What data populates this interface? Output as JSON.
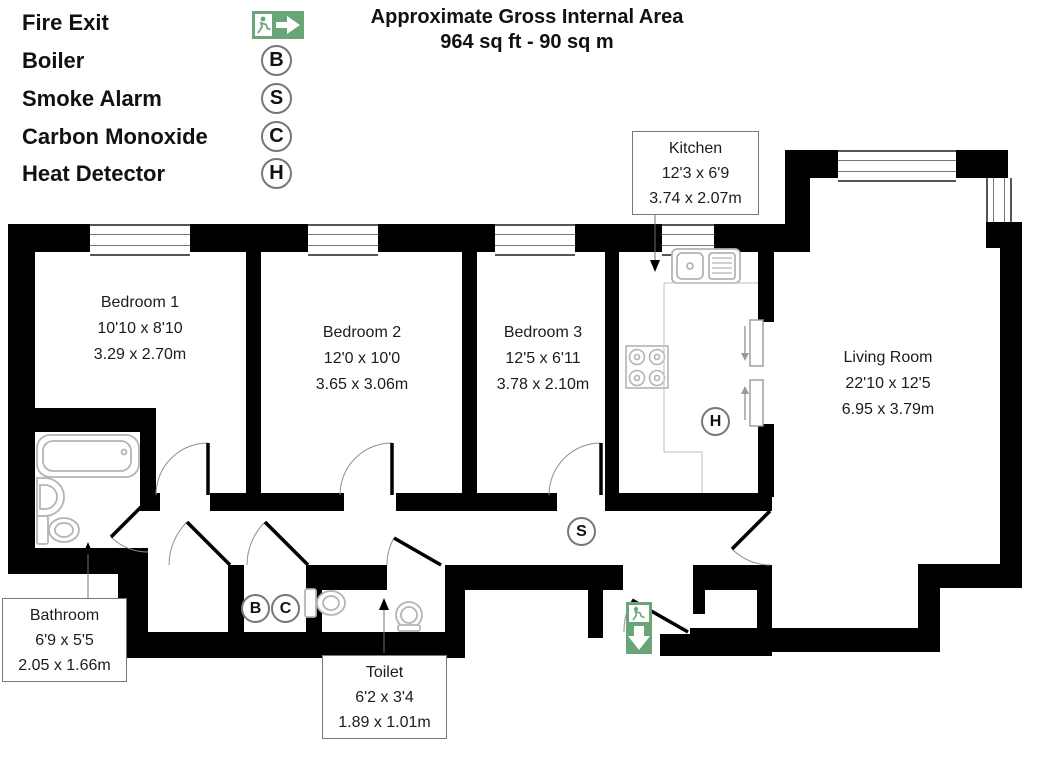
{
  "legend": {
    "items": [
      {
        "label": "Fire Exit",
        "type": "icon",
        "icon": "fire-exit-right-icon"
      },
      {
        "label": "Boiler",
        "type": "circle",
        "letter": "B"
      },
      {
        "label": "Smoke Alarm",
        "type": "circle",
        "letter": "S"
      },
      {
        "label": "Carbon Monoxide",
        "type": "circle",
        "letter": "C"
      },
      {
        "label": "Heat Detector",
        "type": "circle",
        "letter": "H"
      }
    ]
  },
  "title": {
    "line1": "Approximate Gross Internal Area",
    "line2": "964 sq ft - 90 sq m"
  },
  "rooms": {
    "bedroom1": {
      "name": "Bedroom 1",
      "imperial": "10'10 x 8'10",
      "metric": "3.29 x 2.70m"
    },
    "bedroom2": {
      "name": "Bedroom 2",
      "imperial": "12'0 x 10'0",
      "metric": "3.65 x 3.06m"
    },
    "bedroom3": {
      "name": "Bedroom 3",
      "imperial": "12'5 x 6'11",
      "metric": "3.78 x 2.10m"
    },
    "kitchen": {
      "name": "Kitchen",
      "imperial": "12'3 x 6'9",
      "metric": "3.74 x 2.07m"
    },
    "living": {
      "name": "Living Room",
      "imperial": "22'10 x 12'5",
      "metric": "6.95 x 3.79m"
    },
    "bathroom": {
      "name": "Bathroom",
      "imperial": "6'9 x 5'5",
      "metric": "2.05 x 1.66m"
    },
    "toilet": {
      "name": "Toilet",
      "imperial": "6'2 x 3'4",
      "metric": "1.89 x 1.01m"
    }
  },
  "plan_symbols": {
    "smoke_alarm": "S",
    "heat_detector": "H",
    "boiler": "B",
    "carbon_monoxide": "C"
  },
  "icons": {
    "fire_exit_legend": "fire-exit-right-icon",
    "fire_exit_entrance": "fire-exit-down-icon"
  },
  "colors": {
    "exit_green": "#6aa578",
    "wall": "#000000"
  }
}
